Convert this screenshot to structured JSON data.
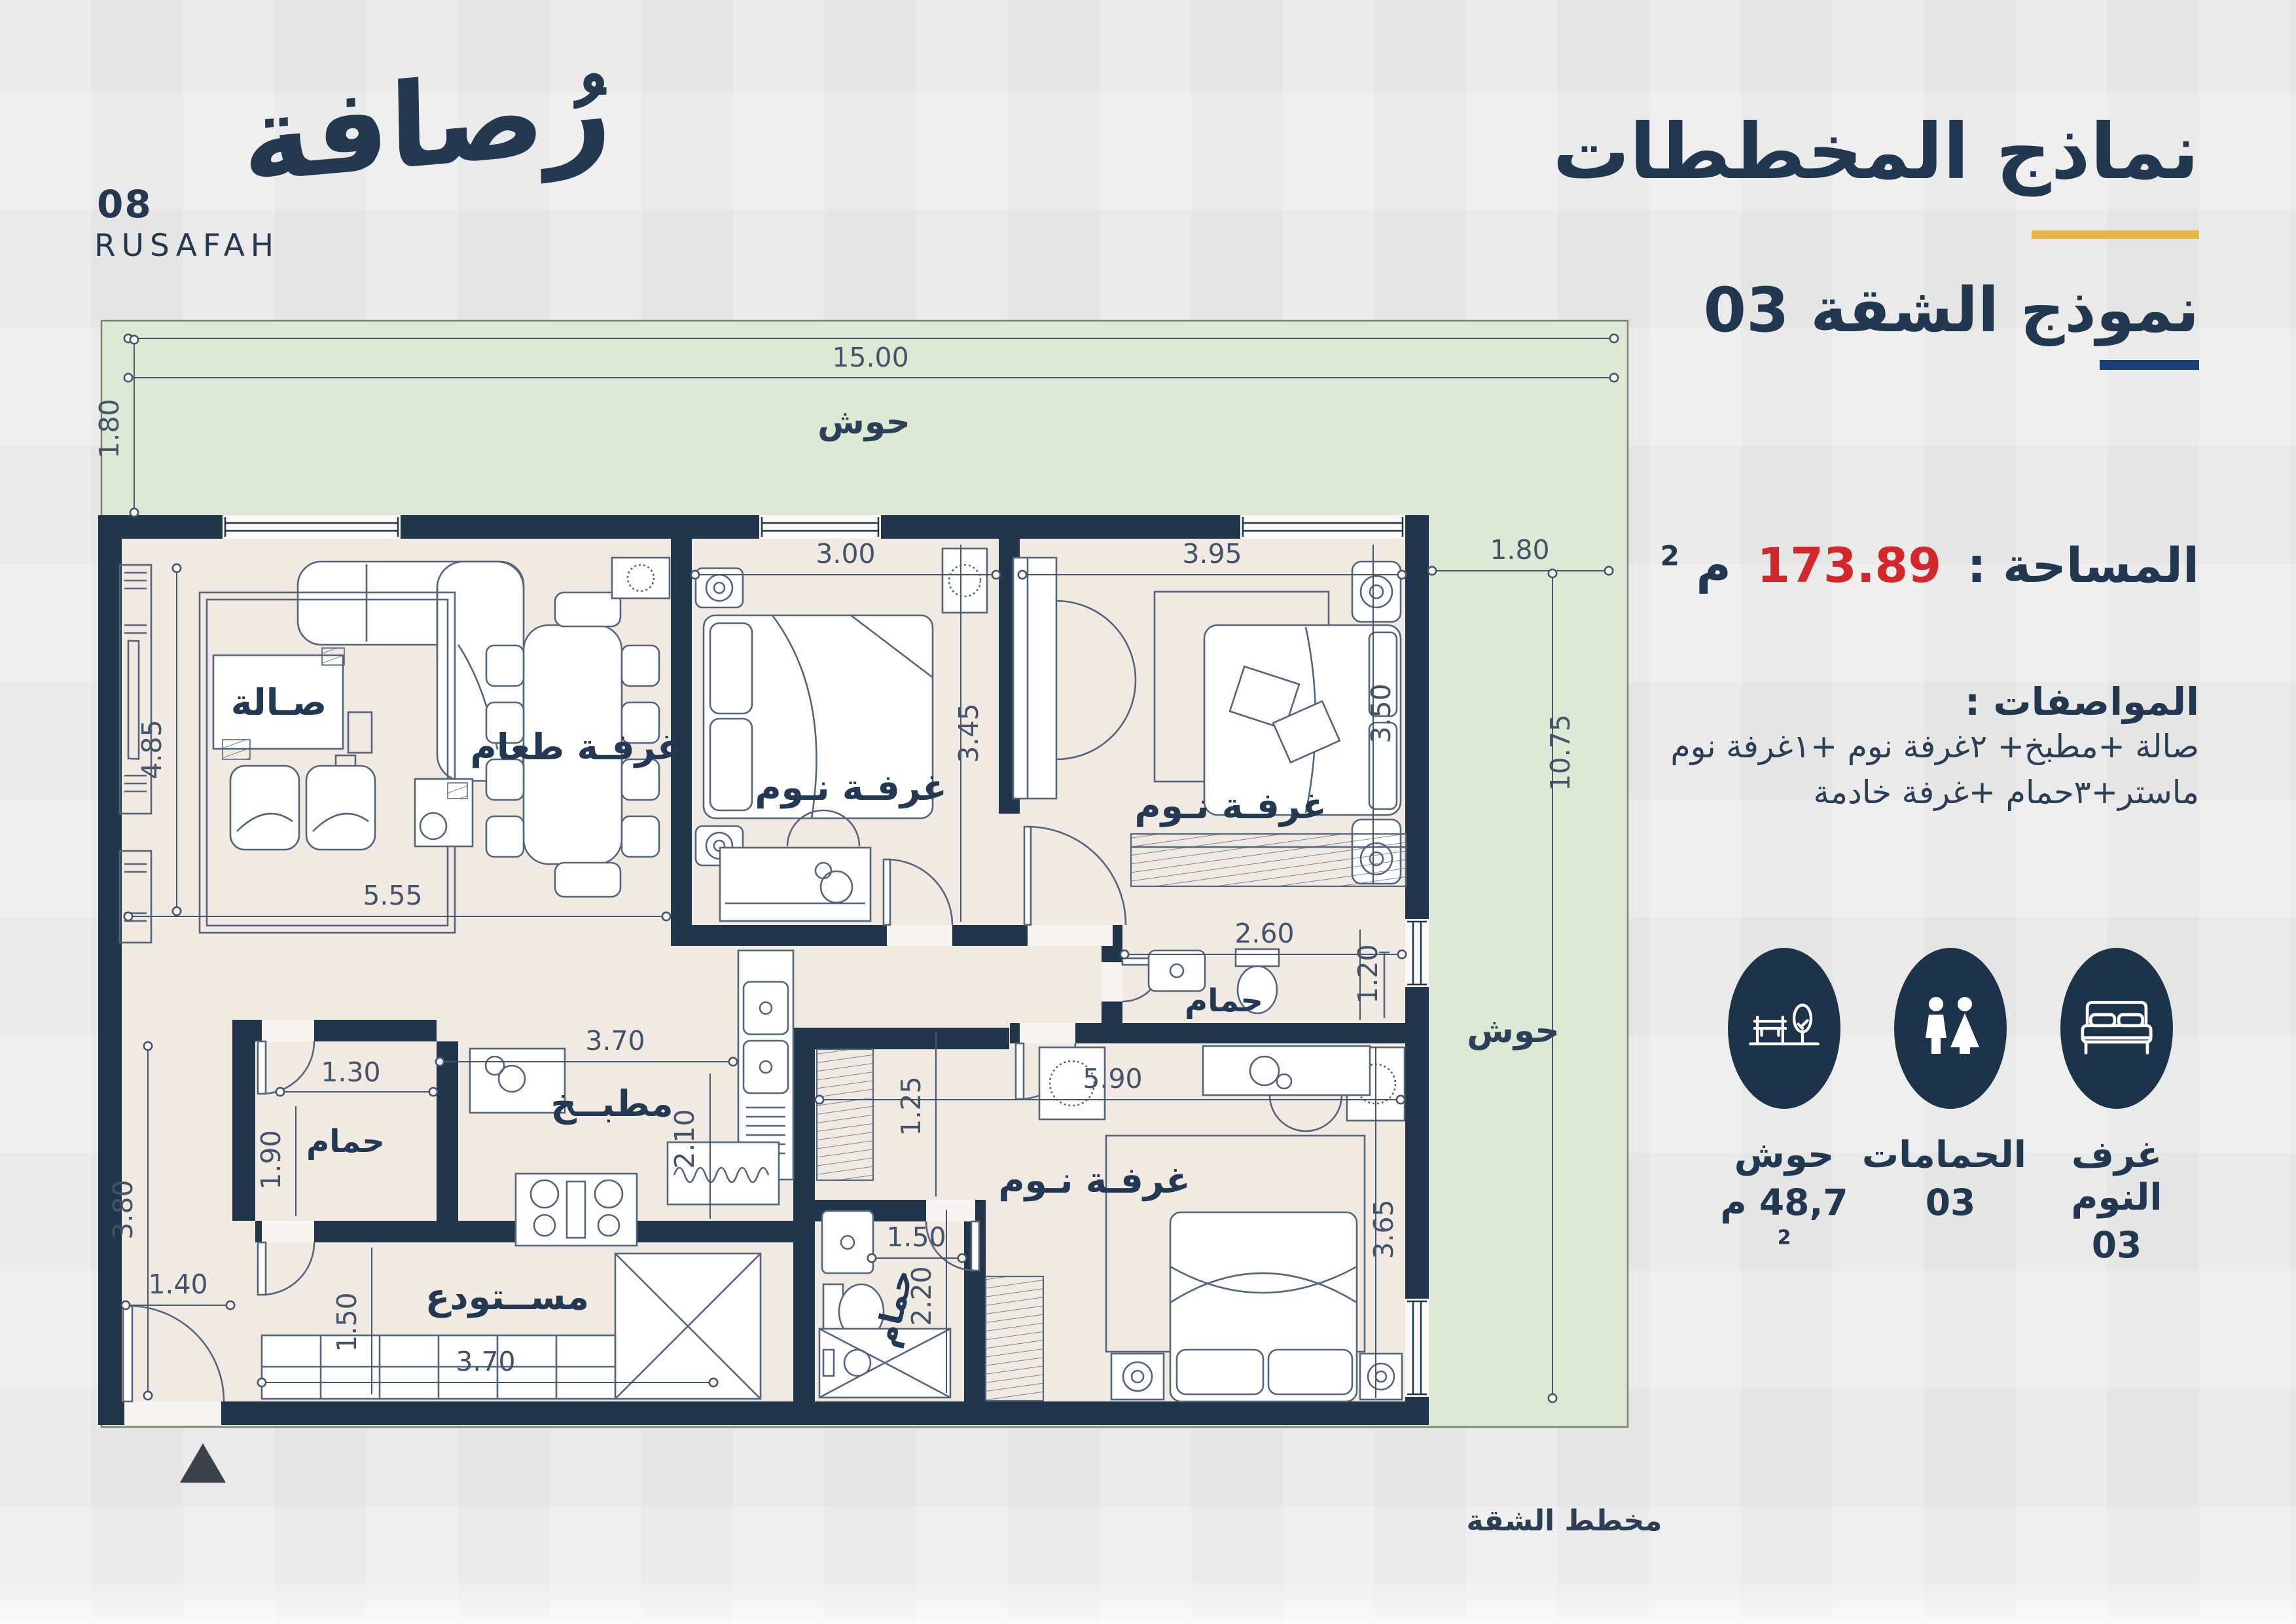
{
  "logo": {
    "name_ar": "رُصافة",
    "number": "08",
    "name_en": "RUSAFAH"
  },
  "panel": {
    "title": "نماذج المخططات",
    "subtitle": "نموذج الشقة 03",
    "area_label": "المساحة :",
    "area_value": "173.89",
    "area_unit": "م",
    "area_sup": "2",
    "specs_title": "المواصفات :",
    "specs_line1": "صالة +مطبخ+ ٢غرفة نوم +١غرفة نوم",
    "specs_line2": "ماستر+٣حمام +غرفة خادمة",
    "stats": [
      {
        "icon": "bed-icon",
        "label": "غرف النوم",
        "value": "03",
        "value_sup": ""
      },
      {
        "icon": "wc-icon",
        "label": "الحمامات",
        "value": "03",
        "value_sup": ""
      },
      {
        "icon": "yard-icon",
        "label": "حوش",
        "value": "48,7 م",
        "value_sup": "2"
      }
    ]
  },
  "plan": {
    "caption": "مخطط الشقة",
    "rooms": {
      "courtyard_top": "حوش",
      "courtyard_right": "حوش",
      "hall": "صـالة",
      "dining": "غرفـة طعام",
      "bedroom1": "غرفـة نـوم",
      "bedroom2": "غرفـة نـوم",
      "master": "غرفـة نـوم",
      "bath_mid": "حمام",
      "bath_left": "حمام",
      "bath_btm": "حمام",
      "kitchen": "مطبــخ",
      "storage": "مســتودع"
    },
    "dims": {
      "site_width": "15.00",
      "site_top_depth": "1.80",
      "side_width": "1.80",
      "side_height": "10.75",
      "hall_h": "4.85",
      "hall_w": "5.55",
      "bed1_w": "3.00",
      "bed1_h": "3.45",
      "bed2_w": "3.95",
      "bed2_h": "3.50",
      "bath_mid_w": "2.60",
      "bath_mid_h": "1.20",
      "kitchen_w": "3.70",
      "kitchen_h": "2.10",
      "bath_left_w": "1.30",
      "bath_left_h": "1.90",
      "hall_low_h": "3.80",
      "entry_w": "1.40",
      "storage_h": "1.50",
      "storage_w": "3.70",
      "master_w": "5.90",
      "master_corr_h": "1.25",
      "master_h": "3.65",
      "bath_btm_w": "1.50",
      "bath_btm_h": "2.20"
    }
  },
  "colors": {
    "navy": "#21354b",
    "red": "#d4272c",
    "gold": "#e9b64d",
    "blue_bar": "#1c3e78",
    "green": "#dde9d5",
    "beige": "#f0eae2",
    "line": "#55657b",
    "background": "#ecedec"
  }
}
